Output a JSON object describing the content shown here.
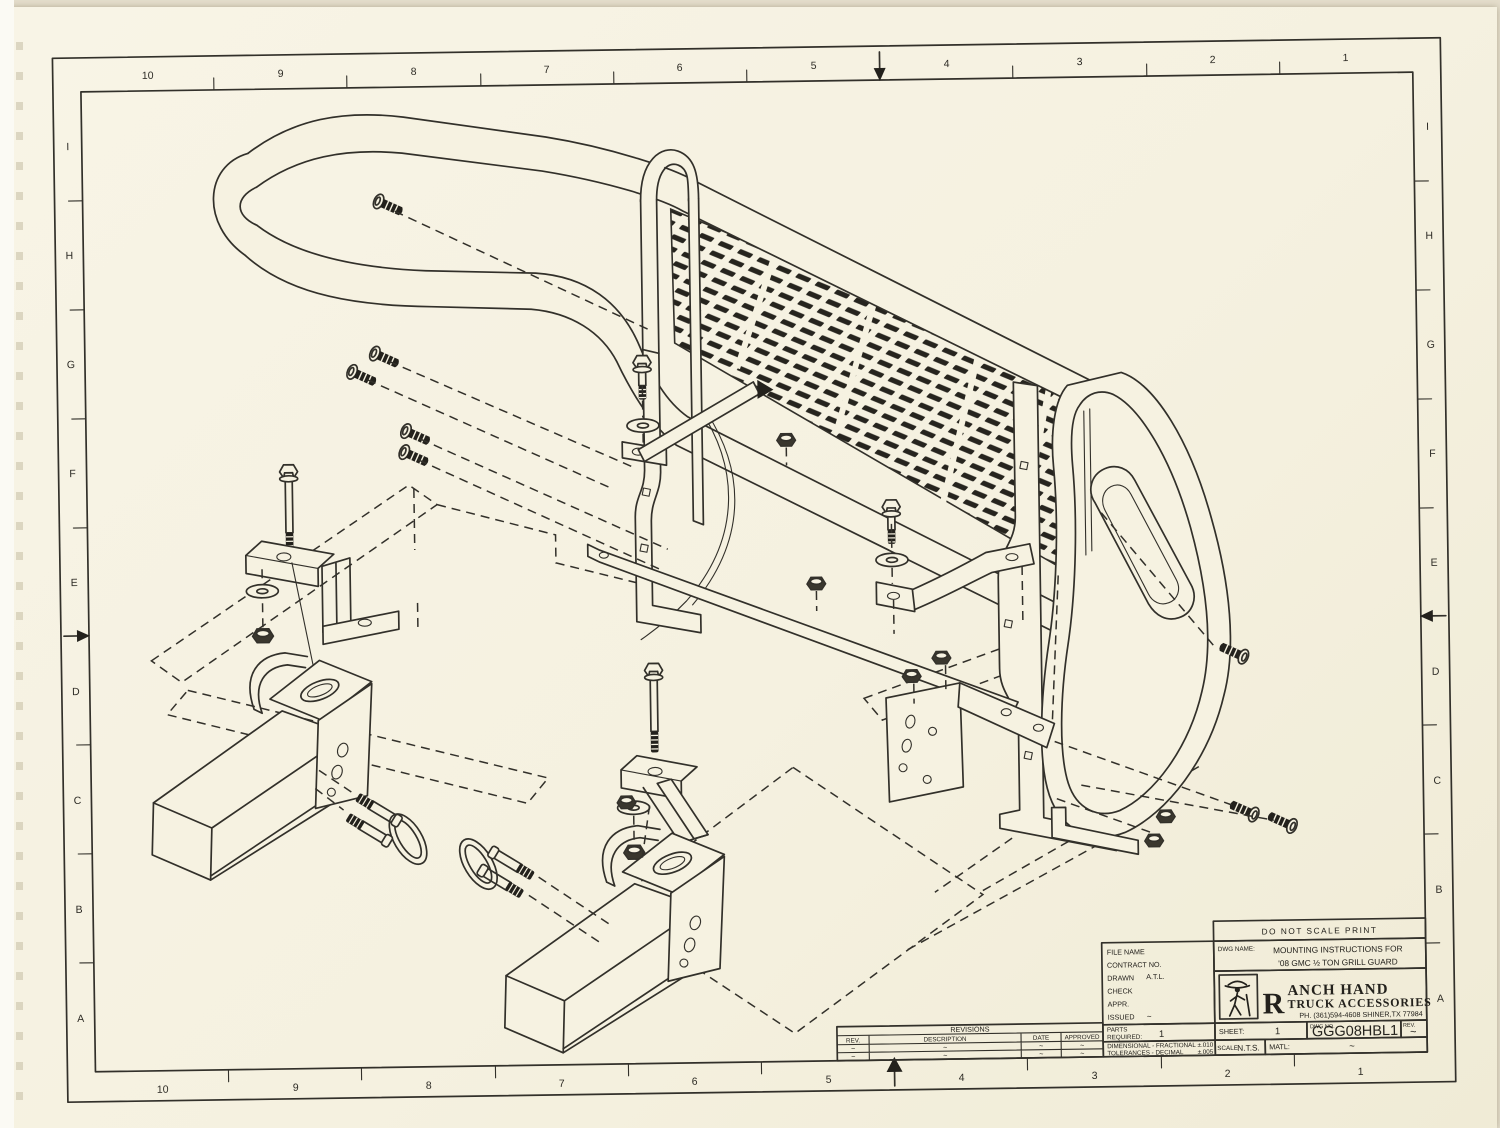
{
  "sheet": {
    "note": "DO NOT SCALE PRINT",
    "paper_color": "#f5f1e0",
    "ink_color": "#32302a"
  },
  "border": {
    "columns": [
      "10",
      "9",
      "8",
      "7",
      "6",
      "5",
      "4",
      "3",
      "2",
      "1"
    ],
    "rows": [
      "I",
      "H",
      "G",
      "F",
      "E",
      "D",
      "C",
      "B",
      "A"
    ]
  },
  "title_block": {
    "file_name_label": "FILE NAME",
    "contract_label": "CONTRACT NO.",
    "drawn_label": "DRAWN",
    "drawn_value": "A.T.L.",
    "check_label": "CHECK",
    "appr_label": "APPR.",
    "issued_label": "ISSUED",
    "issued_value": "~",
    "dwg_name_label": "DWG NAME:",
    "dwg_name_line1": "MOUNTING INSTRUCTIONS FOR",
    "dwg_name_line2": "'08 GMC ½ TON GRILL GUARD",
    "brand_initial": "R",
    "brand_rest": "ANCH HAND",
    "brand_line2": "TRUCK ACCESSORIES",
    "brand_phone": "PH. (361)594-4608 SHINER,TX 77984",
    "parts_label": "PARTS",
    "required_label": "REQUIRED:",
    "parts_value": "1",
    "tol_line1": "DIMENSIONAL - FRACTIONAL",
    "tol_val1": "±.010",
    "tol_line2": "TOLERANCES - DECIMAL",
    "tol_val2": "±.005",
    "sheet_label": "SHEET:",
    "sheet_value": "1",
    "scale_label": "SCALE",
    "scale_value": "N.T.S.",
    "matl_label": "MATL:",
    "matl_value": "~",
    "dwg_no_label": "DWG NO.",
    "dwg_no_value": "GGG08HBL1",
    "rev_label": "REV.",
    "rev_value": "~"
  },
  "revisions": {
    "title": "REVISIONS",
    "headers": [
      "REV.",
      "DESCRIPTION",
      "DATE",
      "APPROVED"
    ],
    "rows": [
      [
        "~",
        "~",
        "~",
        "~"
      ],
      [
        "~",
        "~",
        "~",
        "~"
      ]
    ]
  }
}
